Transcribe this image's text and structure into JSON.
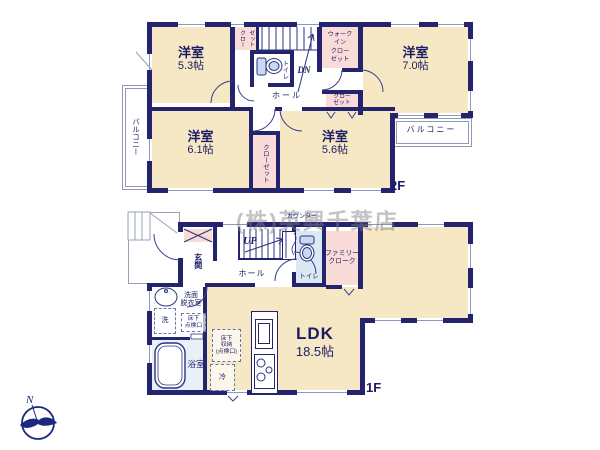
{
  "watermark": "(株)英興千葉店",
  "compass": {
    "north_label": "N"
  },
  "floor2": {
    "floor_label": "2F",
    "rooms": {
      "bedroom_53": {
        "name": "洋室",
        "size": "5.3帖"
      },
      "bedroom_70": {
        "name": "洋室",
        "size": "7.0帖"
      },
      "bedroom_61": {
        "name": "洋室",
        "size": "6.1帖"
      },
      "bedroom_56": {
        "name": "洋室",
        "size": "5.6帖"
      },
      "hall": {
        "name": "ホール"
      },
      "toilet": {
        "name": "トイレ"
      },
      "wic": {
        "name": "ウォーク\nイン\nクロー\nゼット"
      },
      "closet_top": {
        "name": "クロー\nゼット"
      },
      "closet_mid": {
        "name": "クロー\nゼット"
      },
      "closet_bottom": {
        "name": "クローゼット"
      },
      "balcony_left": {
        "name": "バルコニー"
      },
      "balcony_right": {
        "name": "バルコニー"
      },
      "stairs": {
        "label": "DN"
      }
    }
  },
  "floor1": {
    "floor_label": "1F",
    "rooms": {
      "entrance": {
        "name": "玄関"
      },
      "hall": {
        "name": "ホール"
      },
      "stairs": {
        "label": "UP"
      },
      "counter": {
        "name": "カウンター"
      },
      "toilet": {
        "name": "トイレ"
      },
      "family_cloak": {
        "name": "ファミリー\nクローク"
      },
      "ldk": {
        "name": "LDK",
        "size": "18.5帖"
      },
      "washroom": {
        "name": "洗面\n脱衣室"
      },
      "washer": {
        "name": "洗"
      },
      "bathroom": {
        "name": "浴室"
      },
      "fridge": {
        "name": "冷"
      },
      "underfloor_hatch": {
        "name": "床下\n点検口"
      },
      "underfloor_storage": {
        "name": "床下\n収納\n(点検口)"
      }
    }
  }
}
